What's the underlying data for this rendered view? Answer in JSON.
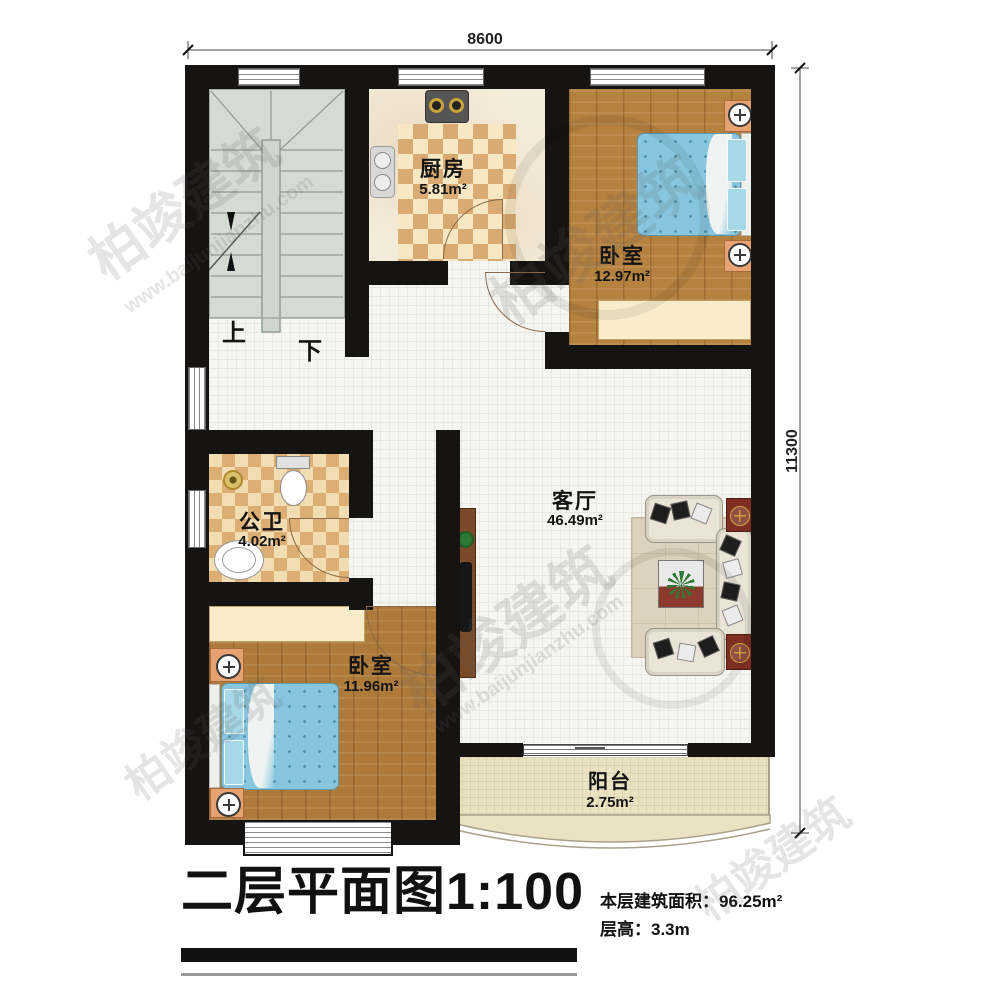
{
  "dimensions": {
    "width": "8600",
    "height": "11300"
  },
  "rooms": {
    "kitchen": {
      "name": "厨房",
      "area": "5.81m²"
    },
    "bedroom1": {
      "name": "卧室",
      "area": "12.97m²"
    },
    "bathroom": {
      "name": "公卫",
      "area": "4.02m²"
    },
    "bedroom2": {
      "name": "卧室",
      "area": "11.96m²"
    },
    "living": {
      "name": "客厅",
      "area": "46.49m²"
    },
    "balcony": {
      "name": "阳台",
      "area": "2.75m²"
    }
  },
  "stairs": {
    "up": "上",
    "down": "下"
  },
  "title": {
    "text": "二层平面图",
    "scale": "1:100"
  },
  "info": {
    "area_label": "本层建筑面积：",
    "area_value": "96.25m²",
    "height_label": "层高：",
    "height_value": "3.3m"
  },
  "watermark": {
    "brand": "柏竣建筑",
    "site": "www.baijunjianzhu.com"
  }
}
